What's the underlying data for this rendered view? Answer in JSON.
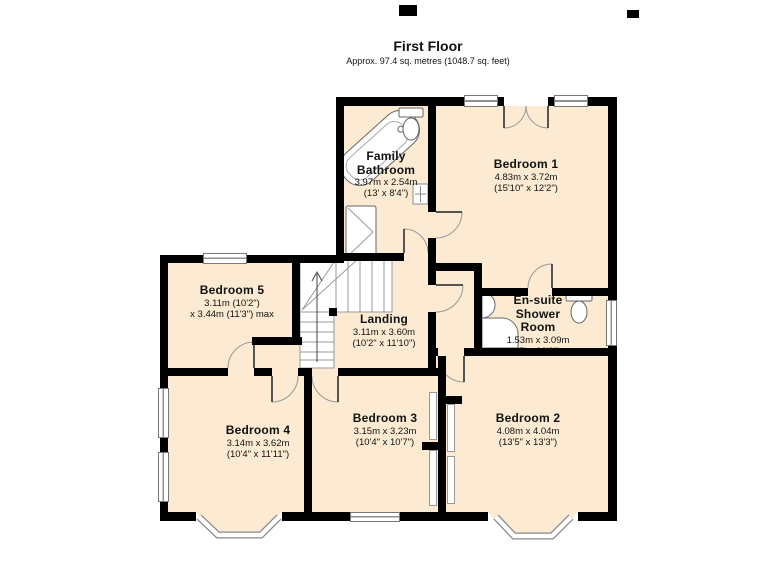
{
  "page": {
    "title": "First Floor",
    "subtitle": "Approx. 97.4 sq. metres (1048.7 sq. feet)"
  },
  "colors": {
    "wall": "#000000",
    "floor_fill": "#fcebd2",
    "fixture_outline": "#666666"
  },
  "rooms": [
    {
      "id": "family-bathroom",
      "name_lines": [
        "Family",
        "Bathroom"
      ],
      "dims": [
        "3.97m x 2.54m",
        "(13' x 8'4\")"
      ]
    },
    {
      "id": "bedroom-1",
      "name_lines": [
        "Bedroom 1"
      ],
      "dims": [
        "4.83m x 3.72m",
        "(15'10\" x 12'2\")"
      ]
    },
    {
      "id": "bedroom-5",
      "name_lines": [
        "Bedroom 5"
      ],
      "dims": [
        "3.11m (10'2\")",
        "x 3.44m (11'3\") max"
      ]
    },
    {
      "id": "landing",
      "name_lines": [
        "Landing"
      ],
      "dims": [
        "3.11m x 3.60m",
        "(10'2\" x 11'10\")"
      ]
    },
    {
      "id": "en-suite-shower-room",
      "name_lines": [
        "En-suite",
        "Shower",
        "Room"
      ],
      "dims": [
        "1.53m x 3.09m",
        "(5' x 10'2\")"
      ]
    },
    {
      "id": "bedroom-4",
      "name_lines": [
        "Bedroom 4"
      ],
      "dims": [
        "3.14m x 3.62m",
        "(10'4\" x 11'11\")"
      ]
    },
    {
      "id": "bedroom-3",
      "name_lines": [
        "Bedroom 3"
      ],
      "dims": [
        "3.15m x 3.23m",
        "(10'4\" x 10'7\")"
      ]
    },
    {
      "id": "bedroom-2",
      "name_lines": [
        "Bedroom 2"
      ],
      "dims": [
        "4.08m x 4.04m",
        "(13'5\" x 13'3\")"
      ]
    }
  ]
}
